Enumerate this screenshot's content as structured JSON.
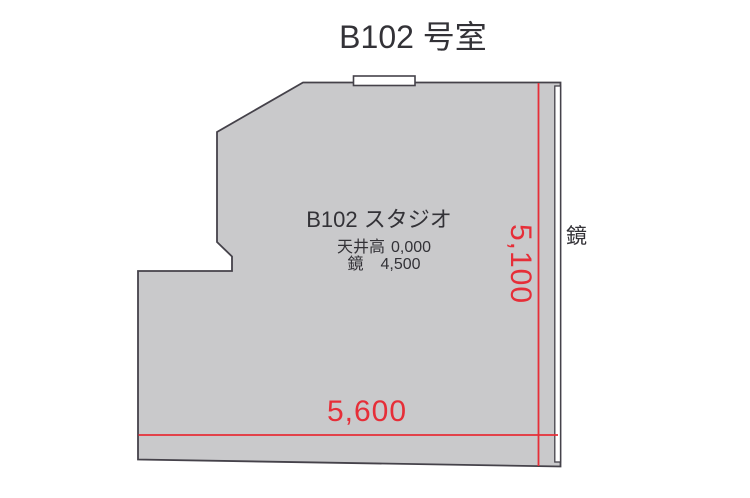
{
  "page": {
    "title": "B102 号室"
  },
  "floor_plan": {
    "room_name": "B102 スタジオ",
    "specs": {
      "ceiling": {
        "label": "天井高",
        "value": "0,000"
      },
      "mirror": {
        "label": "鏡",
        "value": "4,500"
      }
    },
    "dimensions": {
      "width": "5,600",
      "height": "5,100"
    },
    "wall_labels": {
      "mirror": "鏡"
    }
  },
  "colors": {
    "accent_red": "#e62e38",
    "floor_fill": "#c9c9cb",
    "outline": "#45424a",
    "ink": "#333237",
    "background": "#ffffff"
  }
}
